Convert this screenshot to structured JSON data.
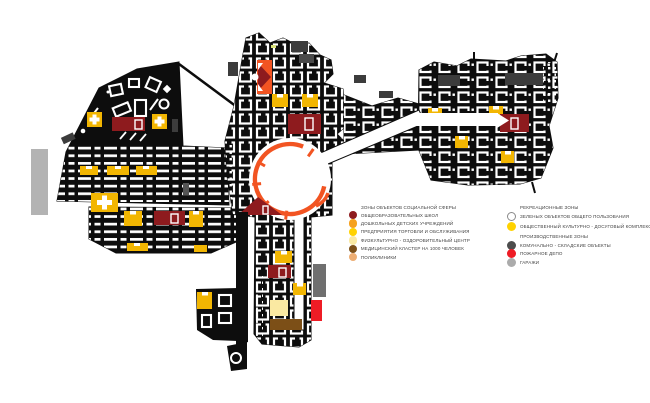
{
  "colors": {
    "block": "#0D0D0D",
    "school": "#8E1B1E",
    "amber": "#F2B602",
    "trade": "#FFD200",
    "fitness": "#FAE9A2",
    "medical": "#7C4F17",
    "polyclinic": "#EDAD72",
    "kindergarten": "#F6A11E",
    "ring": "#F25422",
    "industrial": "#4D4D4D",
    "fire": "#EE1C25",
    "garage": "#ABABAB",
    "graybar": "#B3B3B3",
    "darkunit": "#3C3C3C"
  },
  "legend": {
    "left": {
      "title": "ЗОНЫ ОБЪЕКТОВ СОЦИАЛЬНОЙ СФЕРЫ",
      "items": [
        {
          "label": "ОБЩЕОБРАЗОВАТЕЛЬНЫХ ШКОЛ",
          "color": "#8E1B1E"
        },
        {
          "label": "ДОШКОЛЬНЫХ ДЕТСКИХ УЧРЕЖДЕНИЙ",
          "color": "#F6A11E"
        },
        {
          "label": "ПРЕДПРИЯТИЯ ТОРГОВЛИ И ОБСЛУЖИВАНИЯ",
          "color": "#FFD200"
        },
        {
          "label": "ФИЗКУЛЬТУРНО - ОЗДОРОВИТЕЛЬНЫЙ ЦЕНТР",
          "color": "#FAE9A2"
        },
        {
          "label": "МЕДИЦИНСКИЙ КЛАСТЕР НА 1000 ЧЕЛОВЕК",
          "color": "#7C4F17"
        },
        {
          "label": "ПОЛИКЛИНИКИ",
          "color": "#EDAD72"
        }
      ]
    },
    "right": {
      "sections": [
        {
          "title": "РЕКРЕАЦИОННЫЕ ЗОНЫ",
          "items": [
            {
              "label": "ЗЕЛЕНЫХ ОБЪЕКТОВ ОБЩЕГО ПОЛЬЗОВАНИЯ",
              "color": "#FFFFFF",
              "border": "#8A8A8A"
            },
            {
              "label": "ОБЩЕСТВЕННЫЙ КУЛЬТУРНО - ДОСУГОВЫЙ КОМПЛЕКС",
              "color": "#FFD200"
            }
          ]
        },
        {
          "title": "ПРОИЗВОДСТВЕННЫЕ ЗОНЫ",
          "items": [
            {
              "label": "КОМУНАЛЬНО - СКЛАДСКИЕ ОБЪЕКТЫ",
              "color": "#4D4D4D"
            },
            {
              "label": "ПОЖАРНОЕ ДЕПО",
              "color": "#EE1C25"
            },
            {
              "label": "ГАРАЖИ",
              "color": "#ABABAB"
            }
          ]
        }
      ]
    }
  }
}
